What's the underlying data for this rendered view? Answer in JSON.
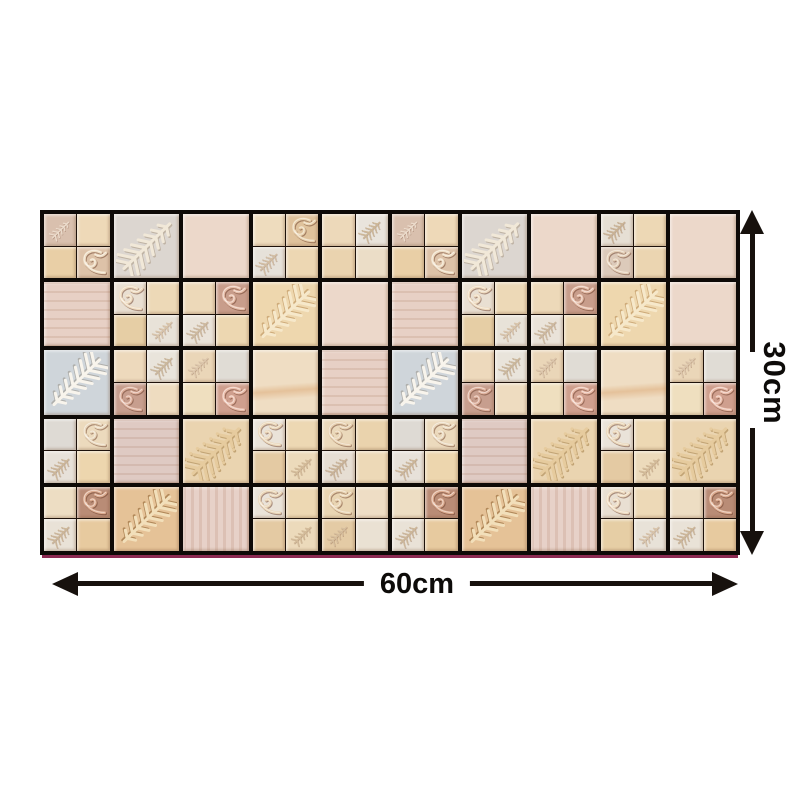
{
  "page": {
    "background": "#ffffff"
  },
  "dimensions": {
    "height_label": "30cm",
    "width_label": "60cm",
    "height_arrow": "double-headed-vertical-arrow",
    "width_arrow": "double-headed-horizontal-arrow",
    "arrow_color": "#17110d",
    "label_color": "#0d0b09"
  },
  "panel": {
    "grout_color": "#0e0a07",
    "bottom_accent_color": "#8c2a52",
    "cols": 10,
    "rows": 5,
    "motif_legend": {
      "fern": "embossed-fern-leaf",
      "fern_dots": "embossed-fern-leaf-dotted",
      "curl": "embossed-scroll-leaf"
    },
    "grid": [
      [
        "qA",
        "BFg",
        "Pp",
        "qD",
        "qE",
        "qA",
        "BFg",
        "Pp",
        "qE2",
        "Pp"
      ],
      [
        "Pp2",
        "qTL",
        "qTRp",
        "BFw",
        "Pp",
        "Pp2",
        "qTL",
        "qTRp",
        "BFw",
        "Pp"
      ],
      [
        "BFwh",
        "qBL",
        "qBRp",
        "Pb",
        "Pp2",
        "BFwh",
        "qBL",
        "qBRp",
        "Pb",
        "qBRp"
      ],
      [
        "qTRc",
        "Pg",
        "BFd",
        "qTL2",
        "qBL2",
        "qTRc",
        "Pg",
        "BFd",
        "qTL2",
        "BFd"
      ],
      [
        "qTRm",
        "BFt",
        "Ps",
        "qTL2",
        "qBL3",
        "qTRm",
        "BFt",
        "Ps",
        "qTL",
        "qTRm"
      ]
    ],
    "tile_types": {
      "Pp": {
        "kind": "plain",
        "bg": "#ecd8ca",
        "tex": "speckle"
      },
      "Pp2": {
        "kind": "plain",
        "bg": "#e7d0c5",
        "tex": "grain"
      },
      "Pb": {
        "kind": "plain",
        "bg": "#efddc3",
        "tex": "streak"
      },
      "Pg": {
        "kind": "plain",
        "bg": "#dfcac3",
        "tex": "grain"
      },
      "Ps": {
        "kind": "plain",
        "bg": "#e7d1c8",
        "tex": "stripes"
      },
      "BFg": {
        "kind": "fern",
        "bg": "#dcd6d0",
        "rib": "#f1e8d8",
        "shadow": "#ad9c88",
        "dir": "ur"
      },
      "BFw": {
        "kind": "fern",
        "bg": "#eed7ae",
        "rib": "#f6e8ca",
        "shadow": "#b98f58",
        "dir": "dl"
      },
      "BFwh": {
        "kind": "fern",
        "bg": "#cfd5da",
        "rib": "#f8f4ec",
        "shadow": "#9a968e",
        "dir": "dl"
      },
      "BFd": {
        "kind": "fern",
        "bg": "#ead4b0",
        "rib": "#e6cb9e",
        "shadow": "#a9854e",
        "dir": "ur",
        "dots": true
      },
      "BFt": {
        "kind": "fern",
        "bg": "#e5c297",
        "rib": "#f2dfba",
        "shadow": "#8f6231",
        "dir": "dl"
      },
      "qA": {
        "kind": "quad",
        "colors": [
          "#d9c0ae",
          "#eed9b8",
          "#e9cfa6",
          "#ddc2a8"
        ],
        "motifs": [
          {
            "q": 0,
            "m": "fern",
            "c": "#ecdccc"
          },
          {
            "q": 3,
            "m": "curl",
            "c": "#eedcc2"
          }
        ]
      },
      "qD": {
        "kind": "quad",
        "colors": [
          "#eedcbe",
          "#dfc29c",
          "#e6e1d9",
          "#edd7b3"
        ],
        "motifs": [
          {
            "q": 1,
            "m": "curl",
            "c": "#e9d2ae"
          },
          {
            "q": 2,
            "m": "fern_dots",
            "c": "#d2bda2"
          }
        ]
      },
      "qE": {
        "kind": "quad",
        "colors": [
          "#edd9ba",
          "#e9e4dc",
          "#ead3af",
          "#ebddc7"
        ],
        "motifs": [
          {
            "q": 1,
            "m": "fern_dots",
            "c": "#ccb696"
          }
        ]
      },
      "qE2": {
        "kind": "quad",
        "colors": [
          "#e6dfd4",
          "#edd8b5",
          "#dccaba",
          "#ebd5b1"
        ],
        "motifs": [
          {
            "q": 0,
            "m": "fern_dots",
            "c": "#c9b294"
          },
          {
            "q": 2,
            "m": "curl",
            "c": "#e4cfb6"
          }
        ]
      },
      "qTL": {
        "kind": "quad",
        "colors": [
          "#e9dfd2",
          "#edd9b7",
          "#e6cea5",
          "#e8e2d8"
        ],
        "motifs": [
          {
            "q": 0,
            "m": "curl",
            "c": "#eedabe"
          },
          {
            "q": 3,
            "m": "fern",
            "c": "#d8c4aa"
          }
        ]
      },
      "qTRp": {
        "kind": "quad",
        "colors": [
          "#edd9b9",
          "#c89d8b",
          "#eae3d9",
          "#edd7b1"
        ],
        "motifs": [
          {
            "q": 1,
            "m": "curl",
            "c": "#e6bda8"
          },
          {
            "q": 2,
            "m": "fern_dots",
            "c": "#cdb99e"
          }
        ]
      },
      "qBL": {
        "kind": "quad",
        "colors": [
          "#edd9bc",
          "#e9e4db",
          "#c79e8e",
          "#eedcc0"
        ],
        "motifs": [
          {
            "q": 1,
            "m": "fern_dots",
            "c": "#cbb89c"
          },
          {
            "q": 2,
            "m": "curl",
            "c": "#deb09c"
          }
        ]
      },
      "qBRp": {
        "kind": "quad",
        "colors": [
          "#ead6b8",
          "#e0dcd5",
          "#efdfbf",
          "#cf9f8e"
        ],
        "motifs": [
          {
            "q": 0,
            "m": "fern",
            "c": "#dcc6ac"
          },
          {
            "q": 3,
            "m": "curl",
            "c": "#e9bba8"
          }
        ]
      },
      "qTRc": {
        "kind": "quad",
        "colors": [
          "#dedad4",
          "#ecdabd",
          "#e7e1d9",
          "#edd6ae"
        ],
        "motifs": [
          {
            "q": 1,
            "m": "curl",
            "c": "#ead8bd"
          },
          {
            "q": 2,
            "m": "fern_dots",
            "c": "#ccb698"
          }
        ]
      },
      "qTL2": {
        "kind": "quad",
        "colors": [
          "#eae3d9",
          "#edd8b3",
          "#e4caa3",
          "#ecdabb"
        ],
        "motifs": [
          {
            "q": 0,
            "m": "curl",
            "c": "#e9d4b5"
          },
          {
            "q": 3,
            "m": "fern",
            "c": "#d3bb99"
          }
        ]
      },
      "qBL2": {
        "kind": "quad",
        "colors": [
          "#ebd9bb",
          "#ead3ad",
          "#e6ded3",
          "#edd9b7"
        ],
        "motifs": [
          {
            "q": 0,
            "m": "curl",
            "c": "#e8d1b0"
          },
          {
            "q": 2,
            "m": "fern_dots",
            "c": "#c9b397"
          }
        ]
      },
      "qTRm": {
        "kind": "quad",
        "colors": [
          "#edddc3",
          "#b98c76",
          "#e9e2d7",
          "#e7ca9f"
        ],
        "motifs": [
          {
            "q": 1,
            "m": "curl",
            "c": "#dcab8f"
          },
          {
            "q": 2,
            "m": "fern_dots",
            "c": "#ccb698"
          }
        ]
      },
      "qBL3": {
        "kind": "quad",
        "colors": [
          "#e9d5b3",
          "#eeddc5",
          "#e4cba5",
          "#eae1d3"
        ],
        "motifs": [
          {
            "q": 0,
            "m": "curl",
            "c": "#e9d3b1"
          },
          {
            "q": 2,
            "m": "fern",
            "c": "#d5bd9d"
          }
        ]
      }
    }
  }
}
